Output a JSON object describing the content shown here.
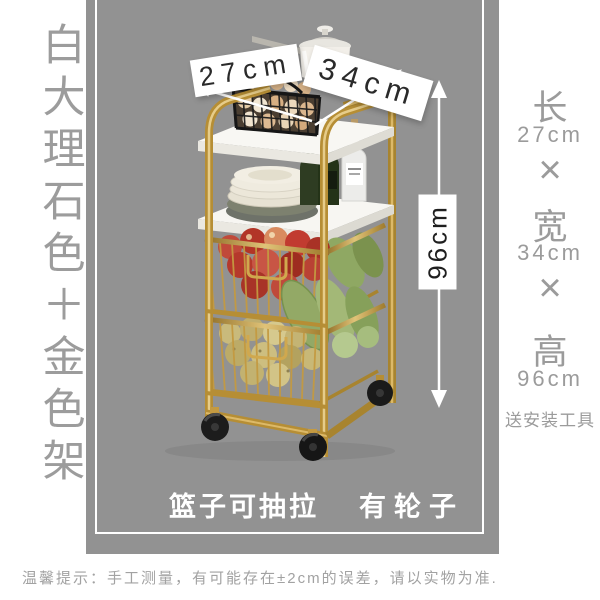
{
  "left_column": {
    "vertical_title": "白大理石色＋金色架"
  },
  "annotations": {
    "front_width": "27cm",
    "side_depth": "34cm",
    "height": "96cm"
  },
  "spec_column": {
    "length_label": "长",
    "length_value": "27cm",
    "times_1": "×",
    "width_label": "宽",
    "width_value": "34cm",
    "times_2": "×",
    "height_label": "高",
    "height_value": "96cm",
    "bonus": "送安装工具"
  },
  "features": {
    "pullout": "篮子可抽拉",
    "wheels": "有轮子"
  },
  "footer": {
    "notice": "温馨提示：手工测量，有可能存在±2cm的误差，请以实物为准."
  },
  "colors": {
    "panel_bg": "#929292",
    "side_text": "#9b9b9b",
    "gold": "#b68e35",
    "banner_bg": "#ffffff",
    "feature_text": "#ffffff"
  }
}
